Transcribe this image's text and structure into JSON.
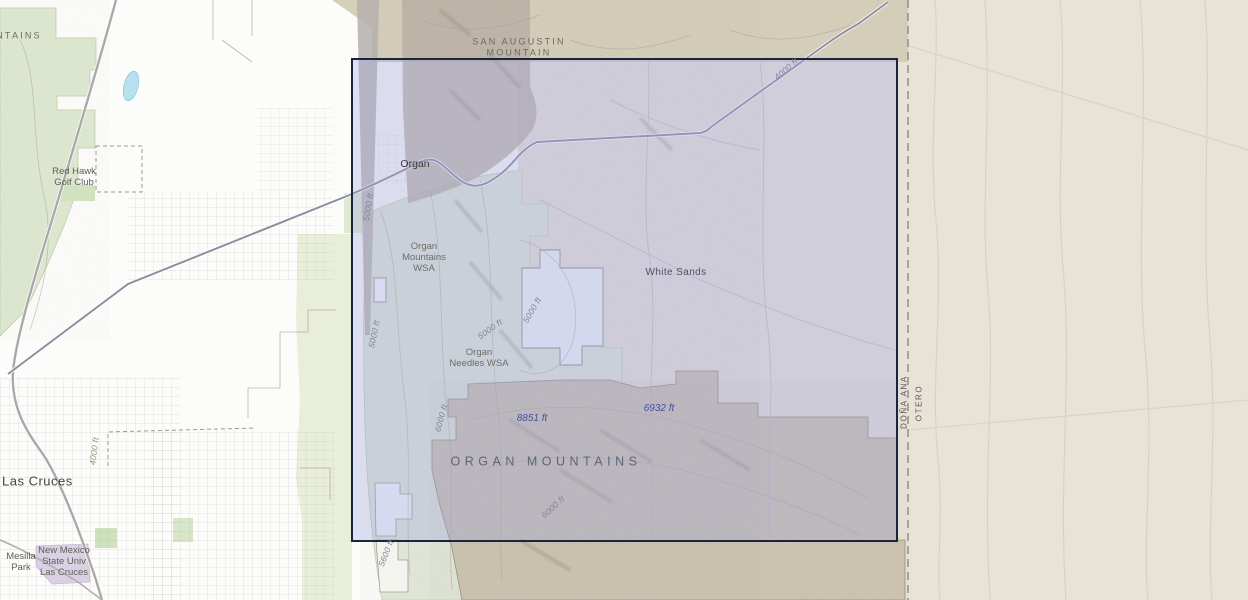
{
  "map": {
    "description": "Topographic basemap of the Organ Mountains and White Sands area east of Las Cruces, New Mexico, with a rectangular selection extent drawn over it",
    "labels": {
      "mountains_partial": "NTAINS",
      "san_augustin": "SAN AUGUSTIN\nMOUNTAIN",
      "red_hawk_golf_club": "Red Hawk\nGolf Club",
      "organ": "Organ",
      "organ_mountains_wsa": "Organ\nMountains\nWSA",
      "organ_needles_wsa": "Organ\nNeedles WSA",
      "white_sands": "White Sands",
      "organ_mountains": "ORGAN MOUNTAINS",
      "las_cruces": "Las Cruces",
      "mesilla_park": "Mesilla\nPark",
      "nmsu": "New Mexico\nState Univ\nLas Cruces",
      "county_dona_ana": "DOÑA ANA",
      "county_otero": "OTERO"
    },
    "elevations": {
      "peak_8851": "8851 ft",
      "peak_6932": "6932 ft"
    },
    "contours": {
      "c1": "4000 ft",
      "c2": "5000 ft",
      "c3": "5000 ft",
      "c4": "5000 ft",
      "c5": "5000 ft",
      "c6": "6000 ft",
      "c7": "6000 ft",
      "c8": "5600 ft",
      "c9": "4000 ft"
    },
    "colors": {
      "selection_fill": "rgba(158,166,225,0.32)",
      "selection_border": "#18253e",
      "county_line": "#8a8a85",
      "wsa_green": "#e2e8d9",
      "monument_tan": "#cdc3b0",
      "desert_beige": "#e8e2d7",
      "highway_gray": "#8f8da2",
      "elevation_blue": "#4350a0",
      "pond_blue": "#b8e0ee"
    }
  }
}
